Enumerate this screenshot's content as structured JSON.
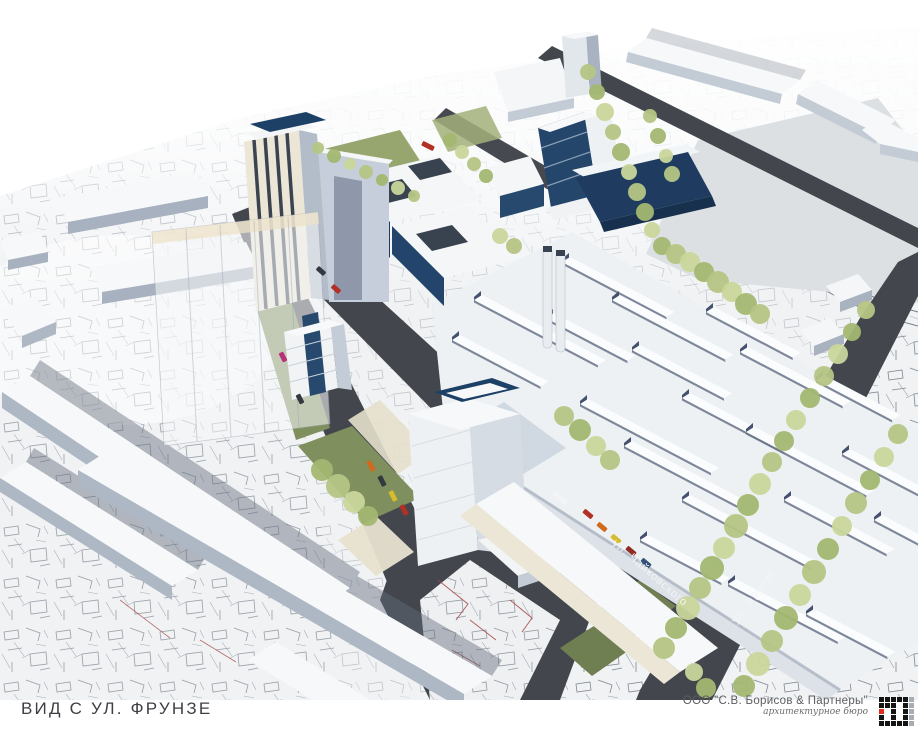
{
  "title_block": {
    "view_title": "ВИД С УЛ. ФРУНЗЕ",
    "company": "ООО \"С.В. Борисов & Партнеры\"",
    "tagline": "архитектурное бюро"
  },
  "scene": {
    "street_labels": [
      {
        "text": "ул. Чайковского"
      },
      {
        "text": "ул. Фрунзе"
      }
    ],
    "colors": {
      "road": "#43474d",
      "map_bg": "#f0f2f4",
      "map_line": "#81888f",
      "building_top": "#f6f8fa",
      "building_shade": "#b3bcc9",
      "facade_cream": "#ebe6d6",
      "glass_blue": "#24466b",
      "wall_blue": "#203d60",
      "lawn": "#7f8f5e",
      "field": "#dce0e3",
      "logo_red": "#e02b1d",
      "logo_black": "#141414",
      "logo_gray": "#a8adb3"
    },
    "tree_colors": [
      "#b5c584",
      "#a3b771",
      "#c9d69b",
      "#8fa463"
    ],
    "trees": [
      [
        588,
        72,
        8,
        0
      ],
      [
        597,
        92,
        8,
        1
      ],
      [
        605,
        112,
        9,
        2
      ],
      [
        613,
        132,
        8,
        0
      ],
      [
        621,
        152,
        9,
        1
      ],
      [
        629,
        172,
        8,
        2
      ],
      [
        637,
        192,
        9,
        0
      ],
      [
        645,
        212,
        9,
        1
      ],
      [
        652,
        230,
        8,
        2
      ],
      [
        650,
        116,
        7,
        0
      ],
      [
        658,
        136,
        8,
        1
      ],
      [
        666,
        156,
        7,
        2
      ],
      [
        672,
        174,
        8,
        0
      ],
      [
        450,
        140,
        7,
        1
      ],
      [
        462,
        152,
        7,
        2
      ],
      [
        474,
        164,
        7,
        0
      ],
      [
        486,
        176,
        7,
        1
      ],
      [
        318,
        148,
        6,
        0
      ],
      [
        334,
        156,
        7,
        1
      ],
      [
        350,
        164,
        6,
        2
      ],
      [
        366,
        172,
        7,
        0
      ],
      [
        382,
        180,
        6,
        1
      ],
      [
        398,
        188,
        7,
        2
      ],
      [
        414,
        196,
        6,
        0
      ],
      [
        662,
        246,
        9,
        1
      ],
      [
        676,
        254,
        10,
        0
      ],
      [
        690,
        262,
        10,
        2
      ],
      [
        704,
        272,
        10,
        1
      ],
      [
        718,
        282,
        11,
        0
      ],
      [
        732,
        292,
        10,
        2
      ],
      [
        746,
        304,
        11,
        1
      ],
      [
        760,
        314,
        10,
        0
      ],
      [
        796,
        420,
        10,
        2
      ],
      [
        810,
        398,
        10,
        1
      ],
      [
        824,
        376,
        10,
        0
      ],
      [
        838,
        354,
        10,
        2
      ],
      [
        852,
        332,
        9,
        1
      ],
      [
        866,
        310,
        9,
        0
      ],
      [
        664,
        648,
        11,
        0
      ],
      [
        676,
        628,
        11,
        1
      ],
      [
        688,
        608,
        12,
        2
      ],
      [
        700,
        588,
        11,
        0
      ],
      [
        712,
        568,
        12,
        1
      ],
      [
        724,
        548,
        11,
        2
      ],
      [
        736,
        526,
        12,
        0
      ],
      [
        748,
        505,
        11,
        1
      ],
      [
        760,
        484,
        11,
        2
      ],
      [
        772,
        462,
        10,
        0
      ],
      [
        784,
        441,
        10,
        1
      ],
      [
        744,
        686,
        11,
        1
      ],
      [
        758,
        664,
        12,
        2
      ],
      [
        772,
        641,
        11,
        0
      ],
      [
        786,
        618,
        12,
        1
      ],
      [
        800,
        595,
        11,
        2
      ],
      [
        814,
        572,
        12,
        0
      ],
      [
        828,
        549,
        11,
        1
      ],
      [
        842,
        526,
        10,
        2
      ],
      [
        856,
        503,
        11,
        0
      ],
      [
        870,
        480,
        10,
        1
      ],
      [
        884,
        457,
        10,
        2
      ],
      [
        898,
        434,
        10,
        0
      ],
      [
        564,
        416,
        10,
        0
      ],
      [
        580,
        430,
        11,
        1
      ],
      [
        596,
        446,
        10,
        2
      ],
      [
        610,
        460,
        10,
        0
      ],
      [
        322,
        470,
        11,
        1
      ],
      [
        338,
        486,
        12,
        0
      ],
      [
        354,
        502,
        11,
        2
      ],
      [
        368,
        516,
        10,
        1
      ],
      [
        500,
        236,
        8,
        2
      ],
      [
        514,
        246,
        8,
        0
      ],
      [
        706,
        688,
        10,
        1
      ],
      [
        694,
        672,
        9,
        2
      ]
    ],
    "cars": [
      [
        428,
        146,
        27,
        "#b23026",
        13
      ],
      [
        560,
        498,
        40,
        "#f2f4f6",
        17
      ],
      [
        588,
        514,
        40,
        "#b23026",
        11
      ],
      [
        602,
        527,
        40,
        "#cf6a1f",
        11
      ],
      [
        616,
        539,
        40,
        "#d6bb2c",
        11
      ],
      [
        631,
        551,
        40,
        "#8f2d23",
        11
      ],
      [
        646,
        563,
        40,
        "#32507a",
        11
      ],
      [
        371,
        466,
        63,
        "#cf6a1f",
        11
      ],
      [
        382,
        481,
        63,
        "#34383f",
        11
      ],
      [
        393,
        496,
        63,
        "#d6bb2c",
        11
      ],
      [
        404,
        510,
        63,
        "#b23026",
        11
      ],
      [
        336,
        289,
        42,
        "#b23026",
        10
      ],
      [
        321,
        271,
        42,
        "#34383f",
        10
      ],
      [
        283,
        357,
        63,
        "#b8307a",
        10
      ],
      [
        300,
        399,
        63,
        "#34383f",
        10
      ]
    ],
    "skylights": [
      [
        474,
        300,
        140
      ],
      [
        452,
        340,
        100
      ],
      [
        546,
        318,
        92
      ],
      [
        562,
        262,
        118
      ],
      [
        612,
        300,
        128
      ],
      [
        632,
        350,
        104
      ],
      [
        580,
        404,
        148
      ],
      [
        624,
        446,
        128
      ],
      [
        682,
        398,
        116
      ],
      [
        706,
        312,
        98
      ],
      [
        740,
        352,
        116
      ],
      [
        816,
        380,
        86
      ],
      [
        746,
        432,
        136
      ],
      [
        682,
        500,
        146
      ],
      [
        640,
        540,
        92
      ],
      [
        784,
        500,
        116
      ],
      [
        842,
        454,
        96
      ],
      [
        874,
        520,
        76
      ],
      [
        728,
        584,
        124
      ],
      [
        806,
        614,
        92
      ]
    ],
    "logo_rows": [
      "bbbbbg",
      "bbbwbg",
      "rwbwbg",
      "bwbwbg",
      "bbbbbg"
    ]
  }
}
